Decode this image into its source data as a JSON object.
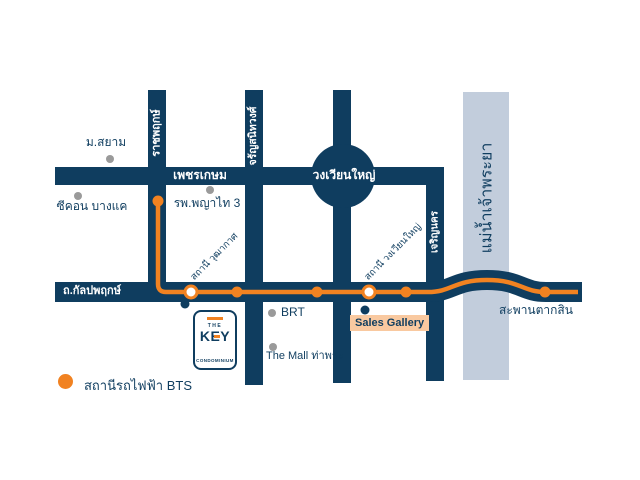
{
  "colors": {
    "navy": "#0f3d5f",
    "orange": "#f18221",
    "gray-dot": "#9a9a9a",
    "river": "#c2cddc",
    "peach": "#f9c9a0",
    "white": "#ffffff"
  },
  "map": {
    "roads": {
      "phetkasem": "เพชรเกษม",
      "wongwian_yai": "วงเวียนใหญ่",
      "ratchaphruek": "ราชพฤกษ์",
      "charansanitwong": "จรัญสนิทวงศ์",
      "charoen_nakhon": "เจริญนคร",
      "kalapapruek": "ถ.กัลปพฤกษ์"
    },
    "river_label": "แม่น้ำเจ้าพระยา",
    "landmarks": {
      "siam_university": "ม.สยาม",
      "seacon_bangkae": "ซีคอน บางแค",
      "phyathai3_hospital": "รพ.พญาไท 3",
      "brt": "BRT",
      "the_mall_thapra": "The Mall ท่าพระ"
    },
    "stations": {
      "wutthakat": "สถานี วุฒากาศ",
      "wongwian_yai": "สถานี วงเวียนใหญ่",
      "saphan_taksin": "สะพานตากสิน"
    },
    "sales_gallery": "Sales Gallery",
    "logo": {
      "the": "THE",
      "key": "KEY",
      "condominium": "CONDOMINIUM"
    },
    "legend": {
      "bts_station": "สถานีรถไฟฟ้า BTS"
    }
  }
}
